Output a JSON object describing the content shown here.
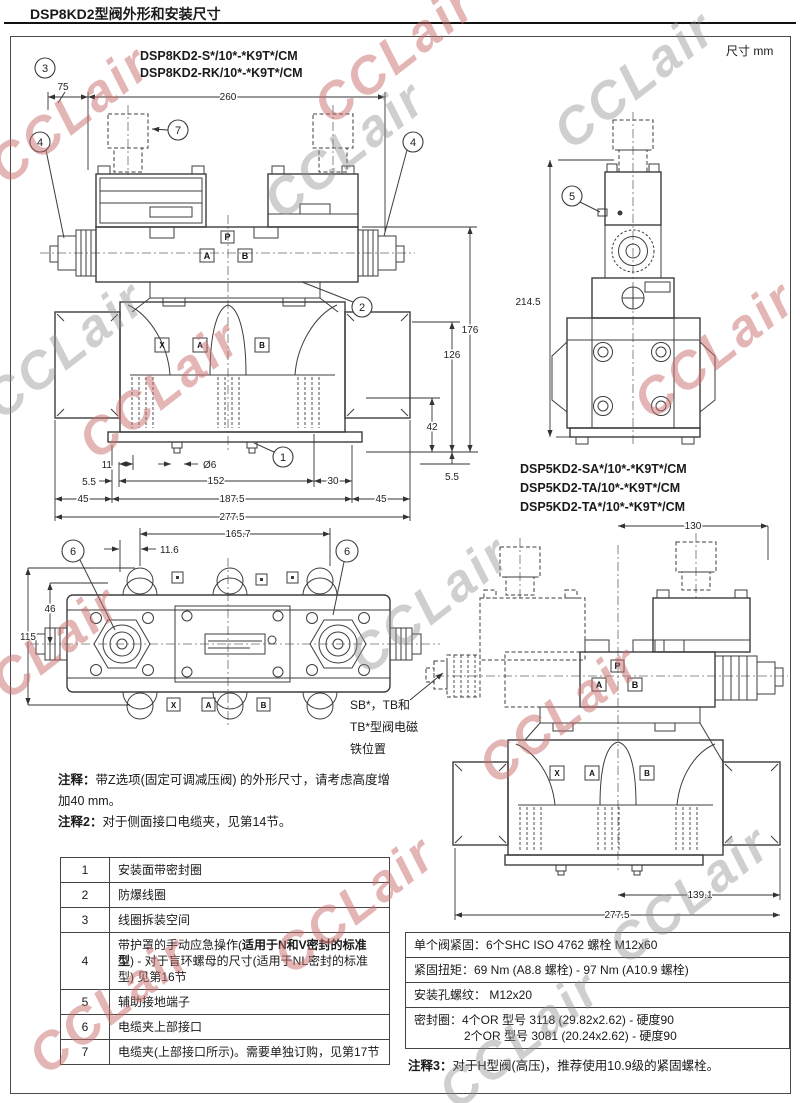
{
  "header": {
    "title": "DSP8KD2型阀外形和安装尺寸",
    "units": "尺寸 mm"
  },
  "watermark": {
    "text": "CCLair"
  },
  "d1": {
    "models": [
      "DSP8KD2-S*/10*-*K9T*/CM",
      "DSP8KD2-RK/10*-*K9T*/CM"
    ],
    "callouts": {
      "c3": "3",
      "c4l": "4",
      "c7": "7",
      "c4r": "4",
      "c2": "2",
      "c1": "1"
    },
    "dims": {
      "offset75": "75",
      "width260": "260",
      "h176": "176",
      "h126": "126",
      "h42": "42",
      "h55": "5.5",
      "b11": "11",
      "dia": "Ø6",
      "b55": "5.5",
      "b152": "152",
      "b30": "30",
      "b45l": "45",
      "b1875": "187.5",
      "b45r": "45",
      "b2775": "277.5"
    },
    "labels": {
      "p": "P",
      "a": "A",
      "b": "B"
    },
    "ports": {
      "x": "X",
      "a": "A",
      "b": "B"
    }
  },
  "d2": {
    "callout": "5",
    "height": "214.5"
  },
  "d3": {
    "callout_left": "6",
    "callout_right": "6",
    "dims": {
      "w1657": "165.7",
      "w116": "11.6",
      "h46": "46",
      "h115": "115"
    },
    "ports": {
      "x": "X",
      "a": "A",
      "b": "B"
    }
  },
  "d4": {
    "models": [
      "DSP5KD2-SA*/10*-*K9T*/CM",
      "DSP5KD2-TA/10*-*K9T*/CM",
      "DSP5KD2-TA*/10*-*K9T*/CM"
    ],
    "dims": {
      "w130": "130",
      "w1391": "139.1",
      "w2775": "277.5"
    },
    "labels": {
      "p": "P",
      "a": "A",
      "b": "B"
    },
    "ports": {
      "x": "X",
      "a": "A",
      "b": "B"
    },
    "solenoid_note": [
      "SB*，TB和",
      "TB*型阀电磁",
      "铁位置"
    ]
  },
  "notes": {
    "n1_label": "注释：",
    "n1_text": "带Z选项(固定可调减压阀) 的外形尺寸，请考虑高度增加40 mm。",
    "n2_label": "注释2：",
    "n2_text": "对于侧面接口电缆夹，见第14节。",
    "n3_label": "注释3：",
    "n3_text": "对于H型阀(高压)，推荐使用10.9级的紧固螺栓。"
  },
  "legend": {
    "rows": [
      {
        "num": "1",
        "text": "安装面带密封圈"
      },
      {
        "num": "2",
        "text": "防爆线圈"
      },
      {
        "num": "3",
        "text": "线圈拆装空间"
      },
      {
        "num": "4",
        "pre": "带护罩的手动应急操作(",
        "bold": "适用于N和V密封的标准型",
        "post": ") - 对于盲环螺母的尺寸(适用于NL密封的标准型) 见第16节"
      },
      {
        "num": "5",
        "text": "辅助接地端子"
      },
      {
        "num": "6",
        "text": "电缆夹上部接口"
      },
      {
        "num": "7",
        "text": "电缆夹(上部接口所示)。需要单独订购，见第17节"
      }
    ]
  },
  "spec": {
    "rows": [
      {
        "text": "单个阀紧固：6个SHC ISO 4762 螺栓 M12x60"
      },
      {
        "text": "紧固扭矩：69 Nm (A8.8 螺栓) - 97 Nm (A10.9 螺栓)"
      },
      {
        "text": "安装孔螺纹： M12x20"
      },
      {
        "line1": "密封圈：4个OR 型号 3118 (29.82x2.62) - 硬度90",
        "line2": "2个OR 型号 3081 (20.24x2.62) - 硬度90"
      }
    ]
  }
}
